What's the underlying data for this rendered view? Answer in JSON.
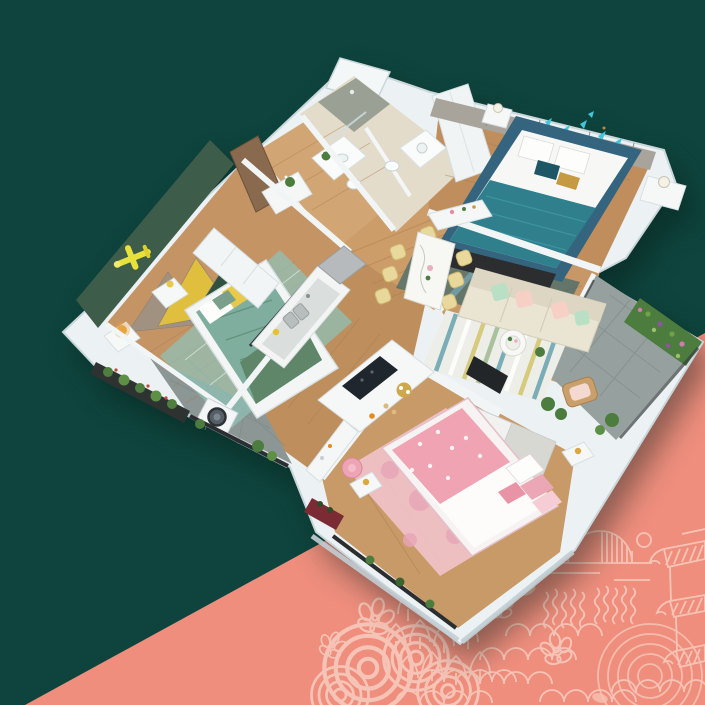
{
  "scene": {
    "title": "3D apartment floor plan render",
    "style": "isometric cutaway interior visualization on split-color backdrop",
    "background": {
      "upper_left_color": "#0E443D",
      "lower_right_color": "#EF8E7D",
      "split": "diagonal divider running from lower-left to upper-right"
    }
  },
  "palette": {
    "background_teal": "#0E443D",
    "background_salmon": "#EF8E7D",
    "pattern_line": "#F7C9BB",
    "wall_white": "#ECF2F4",
    "wall_edge": "#C9D6DA",
    "wood_floor": "#C59464",
    "kids_accent_wall": "#3D5C4A",
    "kids_bedding": "#7FAE9F",
    "master_feature_wall": "#A9A49B",
    "master_bed_frame": "#35647F",
    "master_bed_teal": "#2F7F8D",
    "butterfly_teal": "#43C5DC",
    "sofa_cream": "#EAE4D3",
    "pillow_mint": "#B9DFC5",
    "pillow_blush": "#F6CFC5",
    "dining_chair_yellow": "#E8D89C",
    "pink_bed": "#EFA3B3",
    "pink_rug": "#F3C6D0",
    "plant_green": "#4C7C3E",
    "balcony_tile": "#96A09E",
    "airplane_yellow": "#E8E13C",
    "mountain_yellow": "#E0BF3E"
  },
  "rooms": [
    {
      "name": "Children's bedroom",
      "position": "west",
      "floor": "wood",
      "features": [
        "dark green accent wall",
        "yellow airplane wall decor",
        "mountain-shaped headboard panels",
        "bed with teal-green bedding",
        "teal rug",
        "white nightstands",
        "glowing bedside lamp",
        "white low dresser",
        "balcony planters"
      ]
    },
    {
      "name": "Entry hall",
      "position": "north-west",
      "floor": "wood",
      "features": [
        "open wooden door",
        "white shoe cabinet with plant"
      ]
    },
    {
      "name": "Guest bathroom",
      "position": "north",
      "floor": "beige tile",
      "features": [
        "walk-in shower",
        "white vanity with sink",
        "flower vase",
        "toilet"
      ]
    },
    {
      "name": "Master bathroom",
      "position": "north",
      "floor": "beige tile",
      "features": [
        "vanity with round basin",
        "toilet",
        "mirror"
      ]
    },
    {
      "name": "Master bedroom",
      "position": "north-east",
      "floor": "wood",
      "features": [
        "gray panelled feature wall",
        "teal butterfly wall decor",
        "blue upholstered bed with teal striped blanket",
        "white nightstands with lamps",
        "dark media panel",
        "dark teal rug",
        "white wardrobe block"
      ]
    },
    {
      "name": "Dining area",
      "position": "center",
      "floor": "wood",
      "features": [
        "white marble dining table",
        "pale-yellow chairs",
        "white sideboard with decor"
      ]
    },
    {
      "name": "Living room",
      "position": "east",
      "floor": "wood",
      "features": [
        "cream three-seat sofa",
        "mint and blush pillows",
        "striped rug",
        "round white coffee table",
        "TV on low partition wall",
        "potted plants"
      ]
    },
    {
      "name": "East balcony",
      "position": "east",
      "floor": "gray tile",
      "features": [
        "vertical garden plant wall",
        "rattan lounge chair",
        "potted plants",
        "dark railing"
      ]
    },
    {
      "name": "Kitchen",
      "position": "center-west",
      "floor": "wood",
      "features": [
        "white counter with double sink",
        "gray refrigerator",
        "island with black cooktop",
        "gold breakfast tray",
        "orange juice glass"
      ]
    },
    {
      "name": "Laundry balcony",
      "position": "south-west",
      "floor": "gray decking",
      "features": [
        "white washing machine",
        "flower planters",
        "dark railing"
      ]
    },
    {
      "name": "Pink bedroom",
      "position": "south",
      "floor": "wood",
      "features": [
        "bed with pink patterned duvet",
        "pink watercolor rug",
        "two-tone sliding wardrobe",
        "white desk with pink chair",
        "gold candle lamps",
        "balcony planter row"
      ]
    }
  ],
  "decorations": {
    "corner_motifs": [
      "striped rising sun with moon",
      "tiered pagoda with hatched roofs",
      "five-petal blossoms",
      "water ripple circles",
      "pine tree rows",
      "fish-scale waves",
      "steam squiggle lines",
      "soft petal shapes"
    ]
  }
}
